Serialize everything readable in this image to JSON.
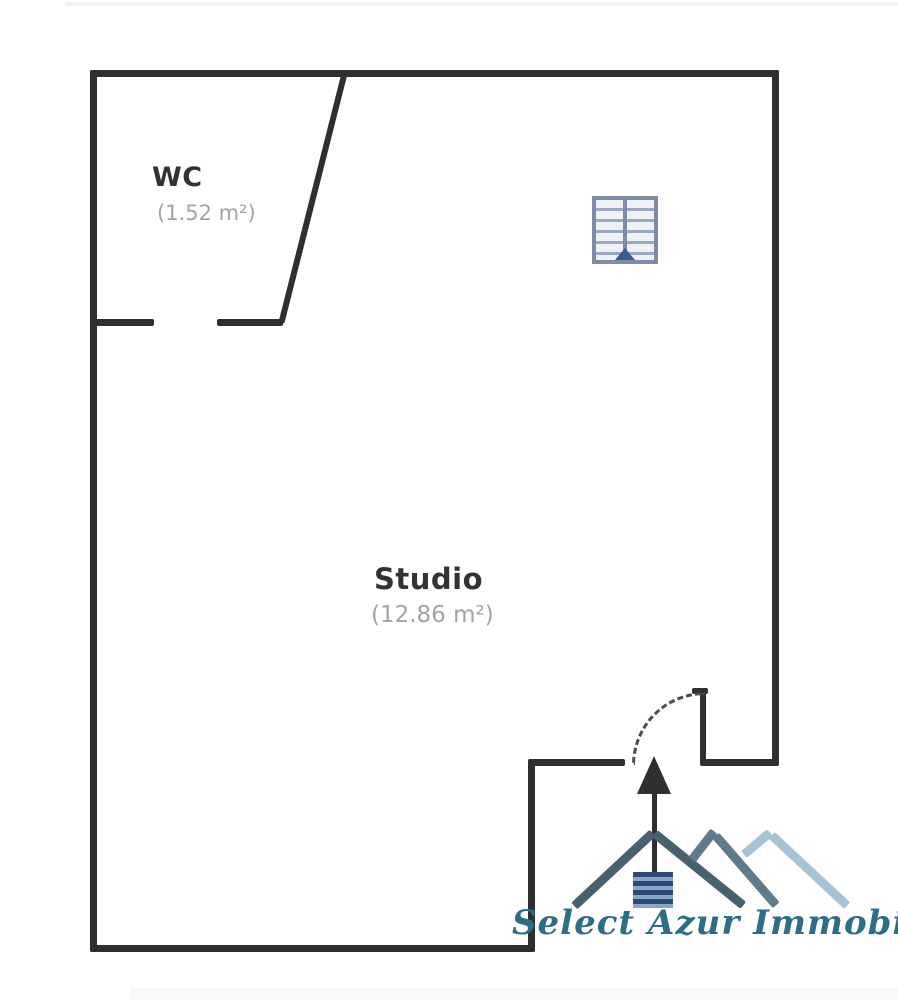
{
  "page": {
    "background": "#ffffff",
    "wall_color": "#2f2f2f"
  },
  "floorplan": {
    "rooms": [
      {
        "name": "WC",
        "area": "(1.52 m²)"
      },
      {
        "name": "Studio",
        "area": "(12.86 m²)"
      }
    ],
    "room_name_color": "#333333",
    "area_text_color": "#a3a3a3",
    "features": [
      {
        "icon": "window-icon",
        "color": "#7e8ca6"
      },
      {
        "icon": "entrance-arrow-icon",
        "color": "#2f2f2f"
      },
      {
        "icon": "door-swing-arc",
        "style": "dashed",
        "color": "#4c4c4c"
      }
    ]
  },
  "logo": {
    "text": "Select Azur Immobilier",
    "text_color": "#2d6e86",
    "roof_dark": "#48616f",
    "roof_medium": "#5f7b8b",
    "roof_light": "#a6c3d6",
    "door_stripe_dark": "#2c4a74",
    "door_stripe_light": "#8aa6c6"
  }
}
